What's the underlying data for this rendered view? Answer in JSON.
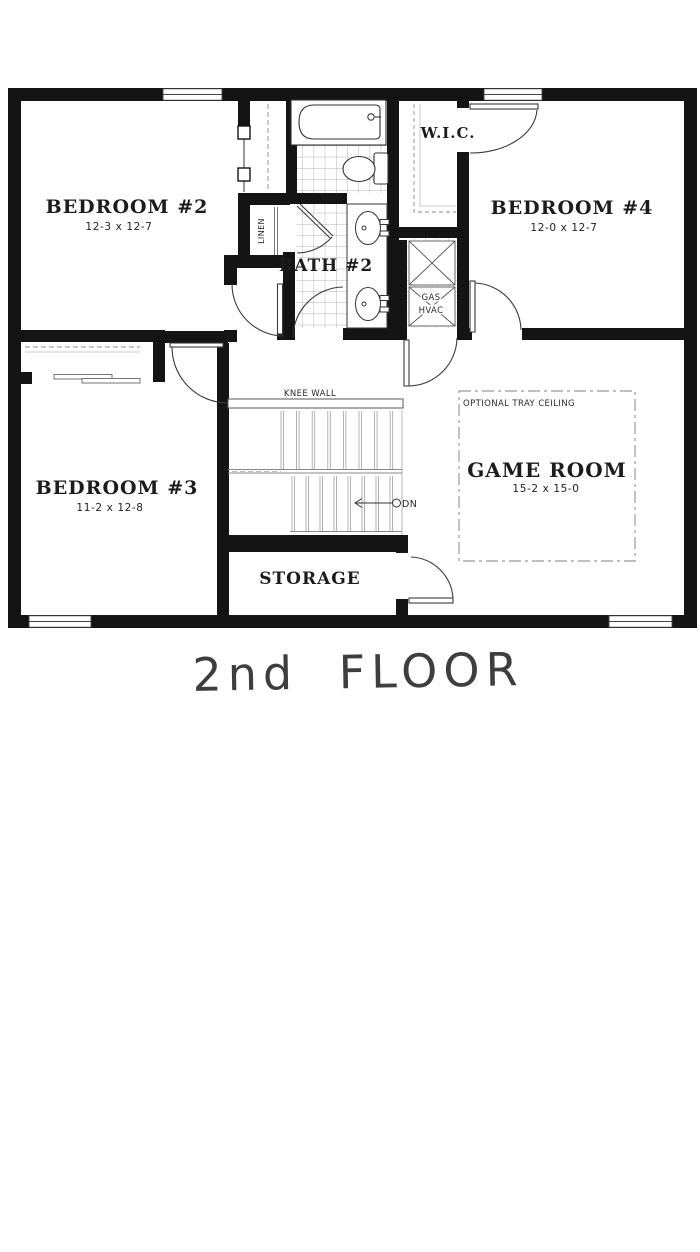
{
  "title": "2nd FLOOR",
  "rooms": {
    "bedroom2": {
      "name": "BEDROOM #2",
      "dims": "12-3 x 12-7"
    },
    "bedroom3": {
      "name": "BEDROOM #3",
      "dims": "11-2 x 12-8"
    },
    "bedroom4": {
      "name": "BEDROOM #4",
      "dims": "12-0 x 12-7"
    },
    "game_room": {
      "name": "GAME ROOM",
      "dims": "15-2 x 15-0",
      "ceiling_note": "OPTIONAL TRAY CEILING"
    },
    "bath2": {
      "name": "BATH #2"
    },
    "wic": {
      "name": "W.I.C."
    },
    "storage": {
      "name": "STORAGE"
    },
    "linen": {
      "name": "LINEN"
    },
    "gas_hvac": {
      "line1": "GAS",
      "line2": "HVAC"
    }
  },
  "stairs": {
    "knee_wall_label": "KNEE WALL",
    "down_label": "DN"
  },
  "colors": {
    "wall": "#141414",
    "accent_line": "#3a3a3a",
    "tile_line": "#999999",
    "title_text": "#3e3e3e"
  }
}
